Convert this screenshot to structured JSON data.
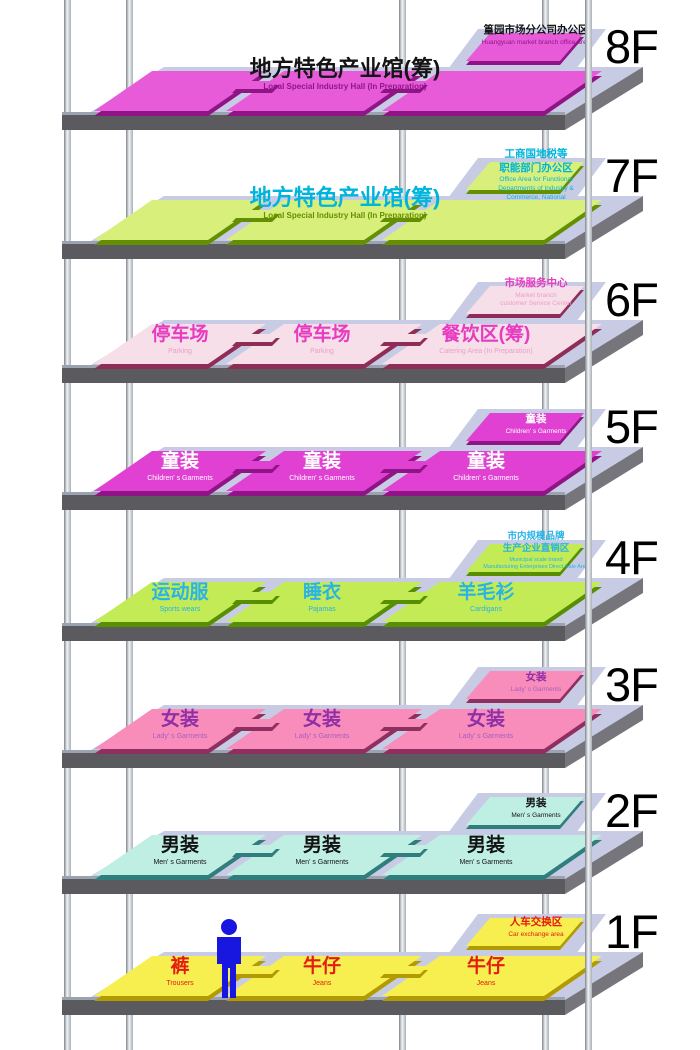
{
  "structure": {
    "slab_top_color": "#c7cce4",
    "slab_front_color": "#5a5a5f",
    "slab_side_color": "#75757b"
  },
  "person": {
    "color": "#1717e0"
  },
  "floors": [
    {
      "floor_label": "8F",
      "main": {
        "cn": "地方特色产业馆(筹)",
        "en": "Local Special Industry Hall (In Preparation)"
      },
      "corner": {
        "cn": "篁园市场分公司办公区",
        "en": "Huangyuan market branch office area"
      },
      "colors": {
        "plate": "#e75bd9",
        "edge": "#8f1586",
        "cn": "#141414",
        "en": "#8f1586",
        "corner_cn": "#141414",
        "corner_en": "#8f1586"
      }
    },
    {
      "floor_label": "7F",
      "main": {
        "cn": "地方特色产业馆(筹)",
        "en": "Local Special Industry Hall (In Preparation)"
      },
      "corner": {
        "cn": "工商国地税等\n职能部门办公区",
        "en": "Office Area for Functional\nDepartments of Industry &\nCommerce, National"
      },
      "colors": {
        "plate": "#d9ef7b",
        "edge": "#648f00",
        "cn": "#00b5dc",
        "en": "#648f00",
        "corner_cn": "#00b5dc",
        "corner_en": "#00b5dc"
      }
    },
    {
      "floor_label": "6F",
      "plates": [
        {
          "cn": "停车场",
          "en": "Parking"
        },
        {
          "cn": "停车场",
          "en": "Parking"
        },
        {
          "cn": "餐饮区(筹)",
          "en": "Catering Area (In Preparation)"
        }
      ],
      "corner": {
        "cn": "市场服务中心",
        "en": "Market branch\ncustomer Service Center"
      },
      "colors": {
        "plate": "#f6dfe9",
        "edge": "#8e2d55",
        "cn": "#e73bc0",
        "en": "#ef9cc6",
        "corner_cn": "#e73bc0",
        "corner_en": "#ef9cc6"
      }
    },
    {
      "floor_label": "5F",
      "plates": [
        {
          "cn": "童装",
          "en": "Children' s Garments"
        },
        {
          "cn": "童装",
          "en": "Children' s Garments"
        },
        {
          "cn": "童装",
          "en": "Children' s Garments"
        }
      ],
      "corner": {
        "cn": "童装",
        "en": "Children' s Garments"
      },
      "colors": {
        "plate": "#e141d3",
        "edge": "#8f1586",
        "cn": "#ffffff",
        "en": "#ffffff",
        "corner_cn": "#ffffff",
        "corner_en": "#ffffff"
      }
    },
    {
      "floor_label": "4F",
      "plates": [
        {
          "cn": "运动服",
          "en": "Sports wears"
        },
        {
          "cn": "睡衣",
          "en": "Pajamas"
        },
        {
          "cn": "羊毛衫",
          "en": "Cardigans"
        }
      ],
      "corner": {
        "cn": "市内规模品牌\n生产企业直销区",
        "en": "Municipal scale brand\nManufacturing Enterprises Direct Sale Area"
      },
      "colors": {
        "plate": "#c3eb55",
        "edge": "#578f00",
        "cn": "#29b3e6",
        "en": "#29b3e6",
        "corner_cn": "#29b3e6",
        "corner_en": "#29b3e6"
      }
    },
    {
      "floor_label": "3F",
      "plates": [
        {
          "cn": "女装",
          "en": "Lady' s Garments"
        },
        {
          "cn": "女装",
          "en": "Lady' s Garments"
        },
        {
          "cn": "女装",
          "en": "Lady' s Garments"
        }
      ],
      "corner": {
        "cn": "女装",
        "en": "Lady' s Garments"
      },
      "colors": {
        "plate": "#f88cbb",
        "edge": "#8f2f60",
        "cn": "#8e2fa6",
        "en": "#a95fc0",
        "corner_cn": "#8e2fa6",
        "corner_en": "#a95fc0"
      }
    },
    {
      "floor_label": "2F",
      "plates": [
        {
          "cn": "男装",
          "en": "Men' s Garments"
        },
        {
          "cn": "男装",
          "en": "Men' s Garments"
        },
        {
          "cn": "男装",
          "en": "Men' s Garments"
        }
      ],
      "corner": {
        "cn": "男装",
        "en": "Men' s Garments"
      },
      "colors": {
        "plate": "#bfeee2",
        "edge": "#2f7d7c",
        "cn": "#121212",
        "en": "#121212",
        "corner_cn": "#121212",
        "corner_en": "#121212"
      }
    },
    {
      "floor_label": "1F",
      "plates": [
        {
          "cn": "裤",
          "en": "Trousers"
        },
        {
          "cn": "牛仔",
          "en": "Jeans"
        },
        {
          "cn": "牛仔",
          "en": "Jeans"
        }
      ],
      "corner": {
        "cn": "人车交换区",
        "en": "Car exchange area"
      },
      "colors": {
        "plate": "#f7ef50",
        "edge": "#b29b00",
        "cn": "#e31b12",
        "en": "#e31b12",
        "corner_cn": "#e31b12",
        "corner_en": "#e31b12"
      }
    }
  ]
}
